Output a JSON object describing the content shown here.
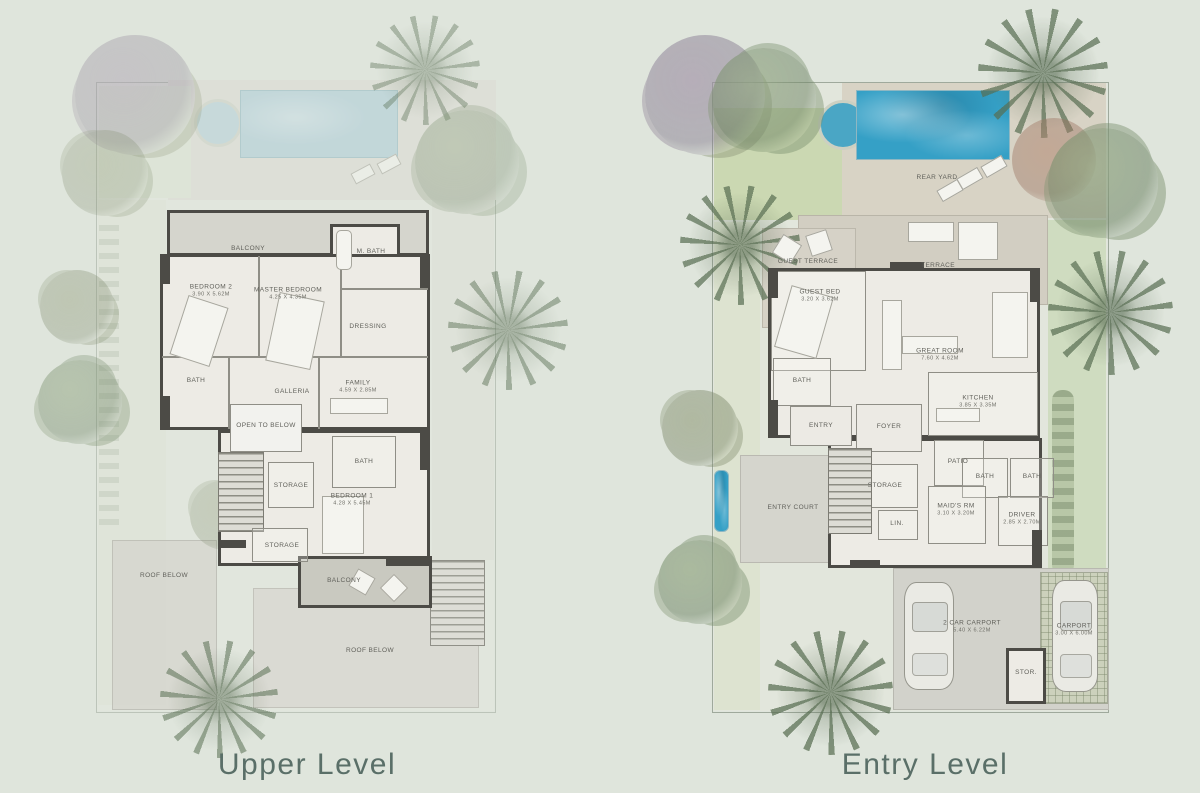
{
  "page": {
    "background_color": "#dfe5dc",
    "title_color": "#5a6f68",
    "wall_color": "#4c4b46",
    "pool_color": "#35a0c6",
    "lawn_color": "#cbd8b2"
  },
  "plans": {
    "upper": {
      "title": "Upper Level",
      "rooms": {
        "balcony_top": {
          "name": "BALCONY"
        },
        "bedroom2": {
          "name": "BEDROOM 2",
          "dims": "3.90 X 5.62M"
        },
        "master": {
          "name": "MASTER BEDROOM",
          "dims": "4.25 X 4.35M"
        },
        "mbath": {
          "name": "M. BATH"
        },
        "dressing": {
          "name": "DRESSING"
        },
        "bath": {
          "name": "BATH"
        },
        "galleria": {
          "name": "GALLERIA"
        },
        "family": {
          "name": "FAMILY",
          "dims": "4.59 X 2.85M"
        },
        "open_below": {
          "name": "OPEN TO BELOW"
        },
        "storage1": {
          "name": "STORAGE"
        },
        "bath1": {
          "name": "BATH"
        },
        "bedroom1": {
          "name": "BEDROOM 1",
          "dims": "4.28 X 5.45M"
        },
        "storage2": {
          "name": "STORAGE"
        },
        "balcony_bottom": {
          "name": "BALCONY"
        },
        "roof_left": {
          "name": "ROOF BELOW"
        },
        "roof_bottom": {
          "name": "ROOF BELOW"
        }
      }
    },
    "entry": {
      "title": "Entry Level",
      "rooms": {
        "rear_yard": {
          "name": "REAR YARD"
        },
        "terrace": {
          "name": "TERRACE"
        },
        "guest_terrace": {
          "name": "GUEST TERRACE"
        },
        "guest_bed": {
          "name": "GUEST BED",
          "dims": "3.20 X 3.62M"
        },
        "great_room": {
          "name": "GREAT ROOM",
          "dims": "7.60 X 4.62M"
        },
        "kitchen": {
          "name": "KITCHEN",
          "dims": "3.85 X 3.35M"
        },
        "bath_guest": {
          "name": "BATH"
        },
        "entry": {
          "name": "ENTRY"
        },
        "foyer": {
          "name": "FOYER"
        },
        "patio": {
          "name": "PATIO"
        },
        "storage": {
          "name": "STORAGE"
        },
        "bath1": {
          "name": "BATH"
        },
        "bath2": {
          "name": "BATH"
        },
        "maids": {
          "name": "MAID'S RM",
          "dims": "3.10 X 3.20M"
        },
        "driver": {
          "name": "DRIVER",
          "dims": "2.85 X 2.70M"
        },
        "linen": {
          "name": "LIN."
        },
        "entry_court": {
          "name": "ENTRY COURT"
        },
        "carport2": {
          "name": "2 CAR CARPORT",
          "dims": "5.40 X 6.22M"
        },
        "stor": {
          "name": "STOR."
        },
        "carport": {
          "name": "CARPORT",
          "dims": "3.00 X 6.00M"
        }
      }
    }
  }
}
